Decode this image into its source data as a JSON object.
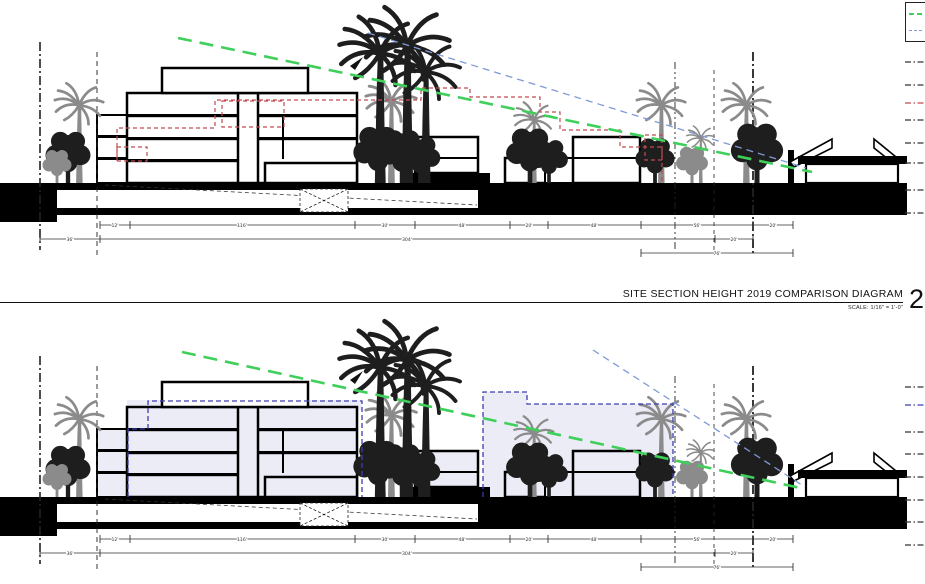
{
  "title_block": {
    "title": "SITE SECTION HEIGHT 2019 COMPARISON DIAGRAM",
    "scale_label": "SCALE: 1/16\" = 1'-0\"",
    "sheet_number": "2"
  },
  "legend": {
    "items": [
      {
        "name": "sight-line-green",
        "label": "P"
      },
      {
        "name": "sight-line-blue",
        "label": "P"
      }
    ]
  },
  "dimensions": {
    "row1": [
      "12'",
      "116'",
      "30'",
      "48'",
      "20'",
      "48'",
      "56'",
      "20'"
    ],
    "row2": [
      "36'",
      "304'",
      "20'"
    ],
    "row3": [
      "76'"
    ]
  },
  "colors": {
    "sight_line_green": "#3fcf5b",
    "sight_line_blue": "#7e9bd6",
    "overlay_2019_red": "#c04a52",
    "overlay_blue": "#3c3cb4",
    "overlay_fill_lavender": "#ececf7",
    "tree_gray": "#8b8b8b",
    "tree_black": "#1e1e1e",
    "ground_black": "#000000"
  },
  "sections": [
    {
      "name": "site-section-existing-vs-2019"
    },
    {
      "name": "site-section-existing-vs-proposed"
    }
  ]
}
